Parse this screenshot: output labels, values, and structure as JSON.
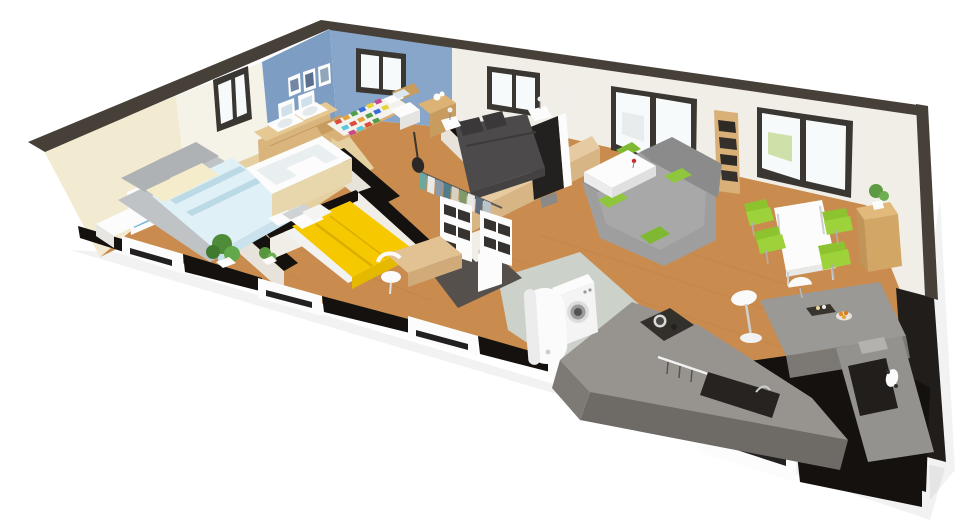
{
  "scene": {
    "description": "3D cutaway floor-plan render of a single-storey house, viewed in perspective from above; walls are sliced horizontally showing dark cut tops; no text is visible in the image",
    "background": "#ffffff",
    "palette": {
      "wallTop": "#474039",
      "cutBlack": "#14110e",
      "cream": "#f2ebd2",
      "warmWhite": "#f5f2e7",
      "blue": "#7d9dc2",
      "blueLight": "#87a6c9",
      "whiteWall": "#f1eee8",
      "wood": "#c98c4e",
      "bathFloor": "#e5d0a2",
      "tile": "#ccd2ca",
      "darkFloor": "#56504c",
      "shadowWall": "#201d1b",
      "sofa": "#9e9e9e",
      "green": "#8ec63e",
      "yellow": "#f6c800",
      "charcoalBed": "#4c4a4a",
      "concrete": "#97948f",
      "concreteDark": "#6e6b67",
      "duvetBlue": "#dff0f7",
      "furnWood": "#d9b078",
      "white": "#fbfbfb"
    },
    "rooms": [
      {
        "name": "bedroom-1",
        "walls": "cream",
        "floor": "wood",
        "contents": [
          "gray double bed with pale-blue patterned duvet",
          "cream pillows",
          "wall poster",
          "white side table",
          "potted plant"
        ]
      },
      {
        "name": "bathroom",
        "walls": "blue / warm white",
        "floor": "beige tile",
        "contents": [
          "wooden vanity with two white sinks",
          "two leaning mirrors",
          "white bathtub with beige panel",
          "window"
        ]
      },
      {
        "name": "bedroom-2",
        "walls": "blue",
        "floor": "wood",
        "contents": [
          "wooden double bed with multicolour patchwork quilt",
          "white nightstand",
          "wooden side table with white toy",
          "three wall pictures",
          "window"
        ]
      },
      {
        "name": "bedroom-3",
        "walls": "white",
        "floor": "wood",
        "contents": [
          "double bed with bright yellow duvet",
          "white and gray pillows",
          "wooden desk with white chair",
          "small plant",
          "white nightstand"
        ]
      },
      {
        "name": "master-bedroom",
        "walls": "white",
        "floor": "wood",
        "contents": [
          "charcoal double bed",
          "two white nightstands with lamps",
          "window",
          "TV on low wooden half-wall",
          "open wardrobe with hanging clothes",
          "white cube shelving",
          "guitar"
        ]
      },
      {
        "name": "living-room",
        "walls": "white",
        "floor": "wood",
        "contents": [
          "gray L-shaped sofa with green cushions",
          "white coffee table with red flower",
          "tall wooden bookshelf",
          "two dark-framed sliding glass doors"
        ]
      },
      {
        "name": "dining-area",
        "walls": "white",
        "floor": "wood",
        "contents": [
          "white rectangular table",
          "four green chairs",
          "wooden sideboard with plant"
        ]
      },
      {
        "name": "kitchen",
        "walls": "dark",
        "floor": "wood",
        "contents": [
          "L-shaped concrete counter",
          "dark cooktop with pot",
          "utensil rail",
          "dark sink with faucet",
          "bar island with dome lamp, tray and fruit bowl",
          "white bar stool",
          "small appliances"
        ]
      },
      {
        "name": "utility-room",
        "walls": "white",
        "floor": "sage tile",
        "contents": [
          "washing machine",
          "white cylindrical water heater"
        ]
      },
      {
        "name": "entrance-hall",
        "walls": "dark gray",
        "floor": "dark",
        "contents": [
          "white front door"
        ]
      }
    ]
  }
}
